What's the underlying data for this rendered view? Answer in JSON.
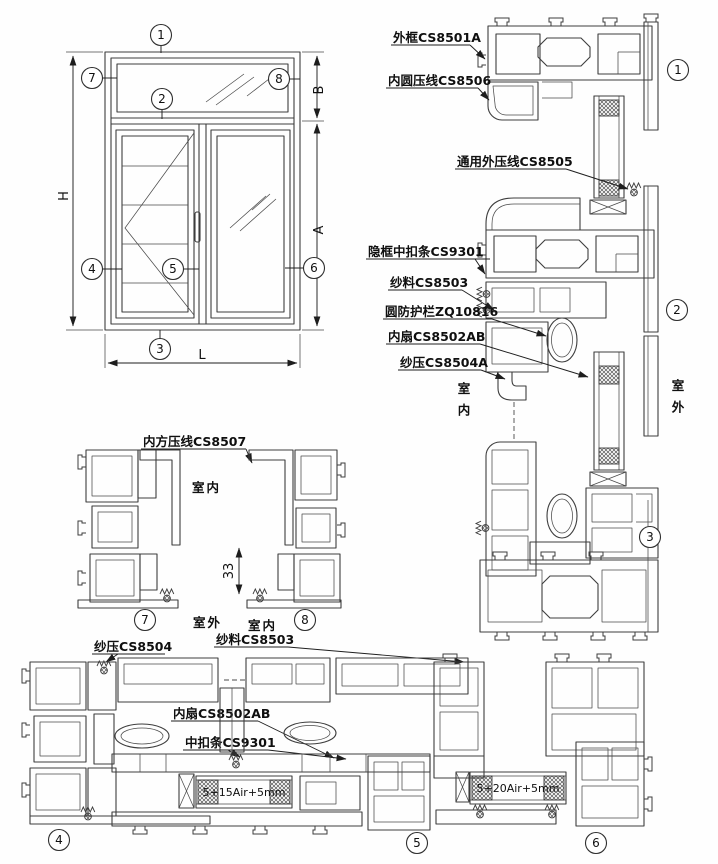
{
  "callouts": {
    "n1": "1",
    "n2": "2",
    "n3": "3",
    "n4": "4",
    "n5": "5",
    "n6": "6",
    "n7": "7",
    "n8": "8"
  },
  "elevation": {
    "dim_h": "H",
    "dim_l": "L",
    "dim_a": "A",
    "dim_b": "B"
  },
  "right_section": {
    "label_outer_frame": "外框CS8501A",
    "label_inner_round_bead": "内圆压线CS8506",
    "label_universal_outer_bead": "通用外压线CS8505",
    "label_hidden_frame_clip": "隐框中扣条CS9301",
    "label_screen_mesh": "纱料CS8503",
    "label_round_guard": "圆防护栏ZQ10816",
    "label_inner_sash": "内扇CS8502AB",
    "label_screen_bead": "纱压CS8504A",
    "indoor": "室内",
    "outdoor": "室外"
  },
  "mid_section": {
    "label_inner_square_bead": "内方压线CS8507",
    "indoor": "室内",
    "outdoor": "室外",
    "indoor2": "室内",
    "dim_33": "33"
  },
  "bottom_section": {
    "label_screen_bead": "纱压CS8504",
    "label_screen_mesh": "纱料CS8503",
    "label_inner_sash": "内扇CS8502AB",
    "label_middle_clip": "中扣条CS9301",
    "glass_spec_1": "5+15Air+5mm",
    "glass_spec_2": "5+20Air+5mm"
  }
}
